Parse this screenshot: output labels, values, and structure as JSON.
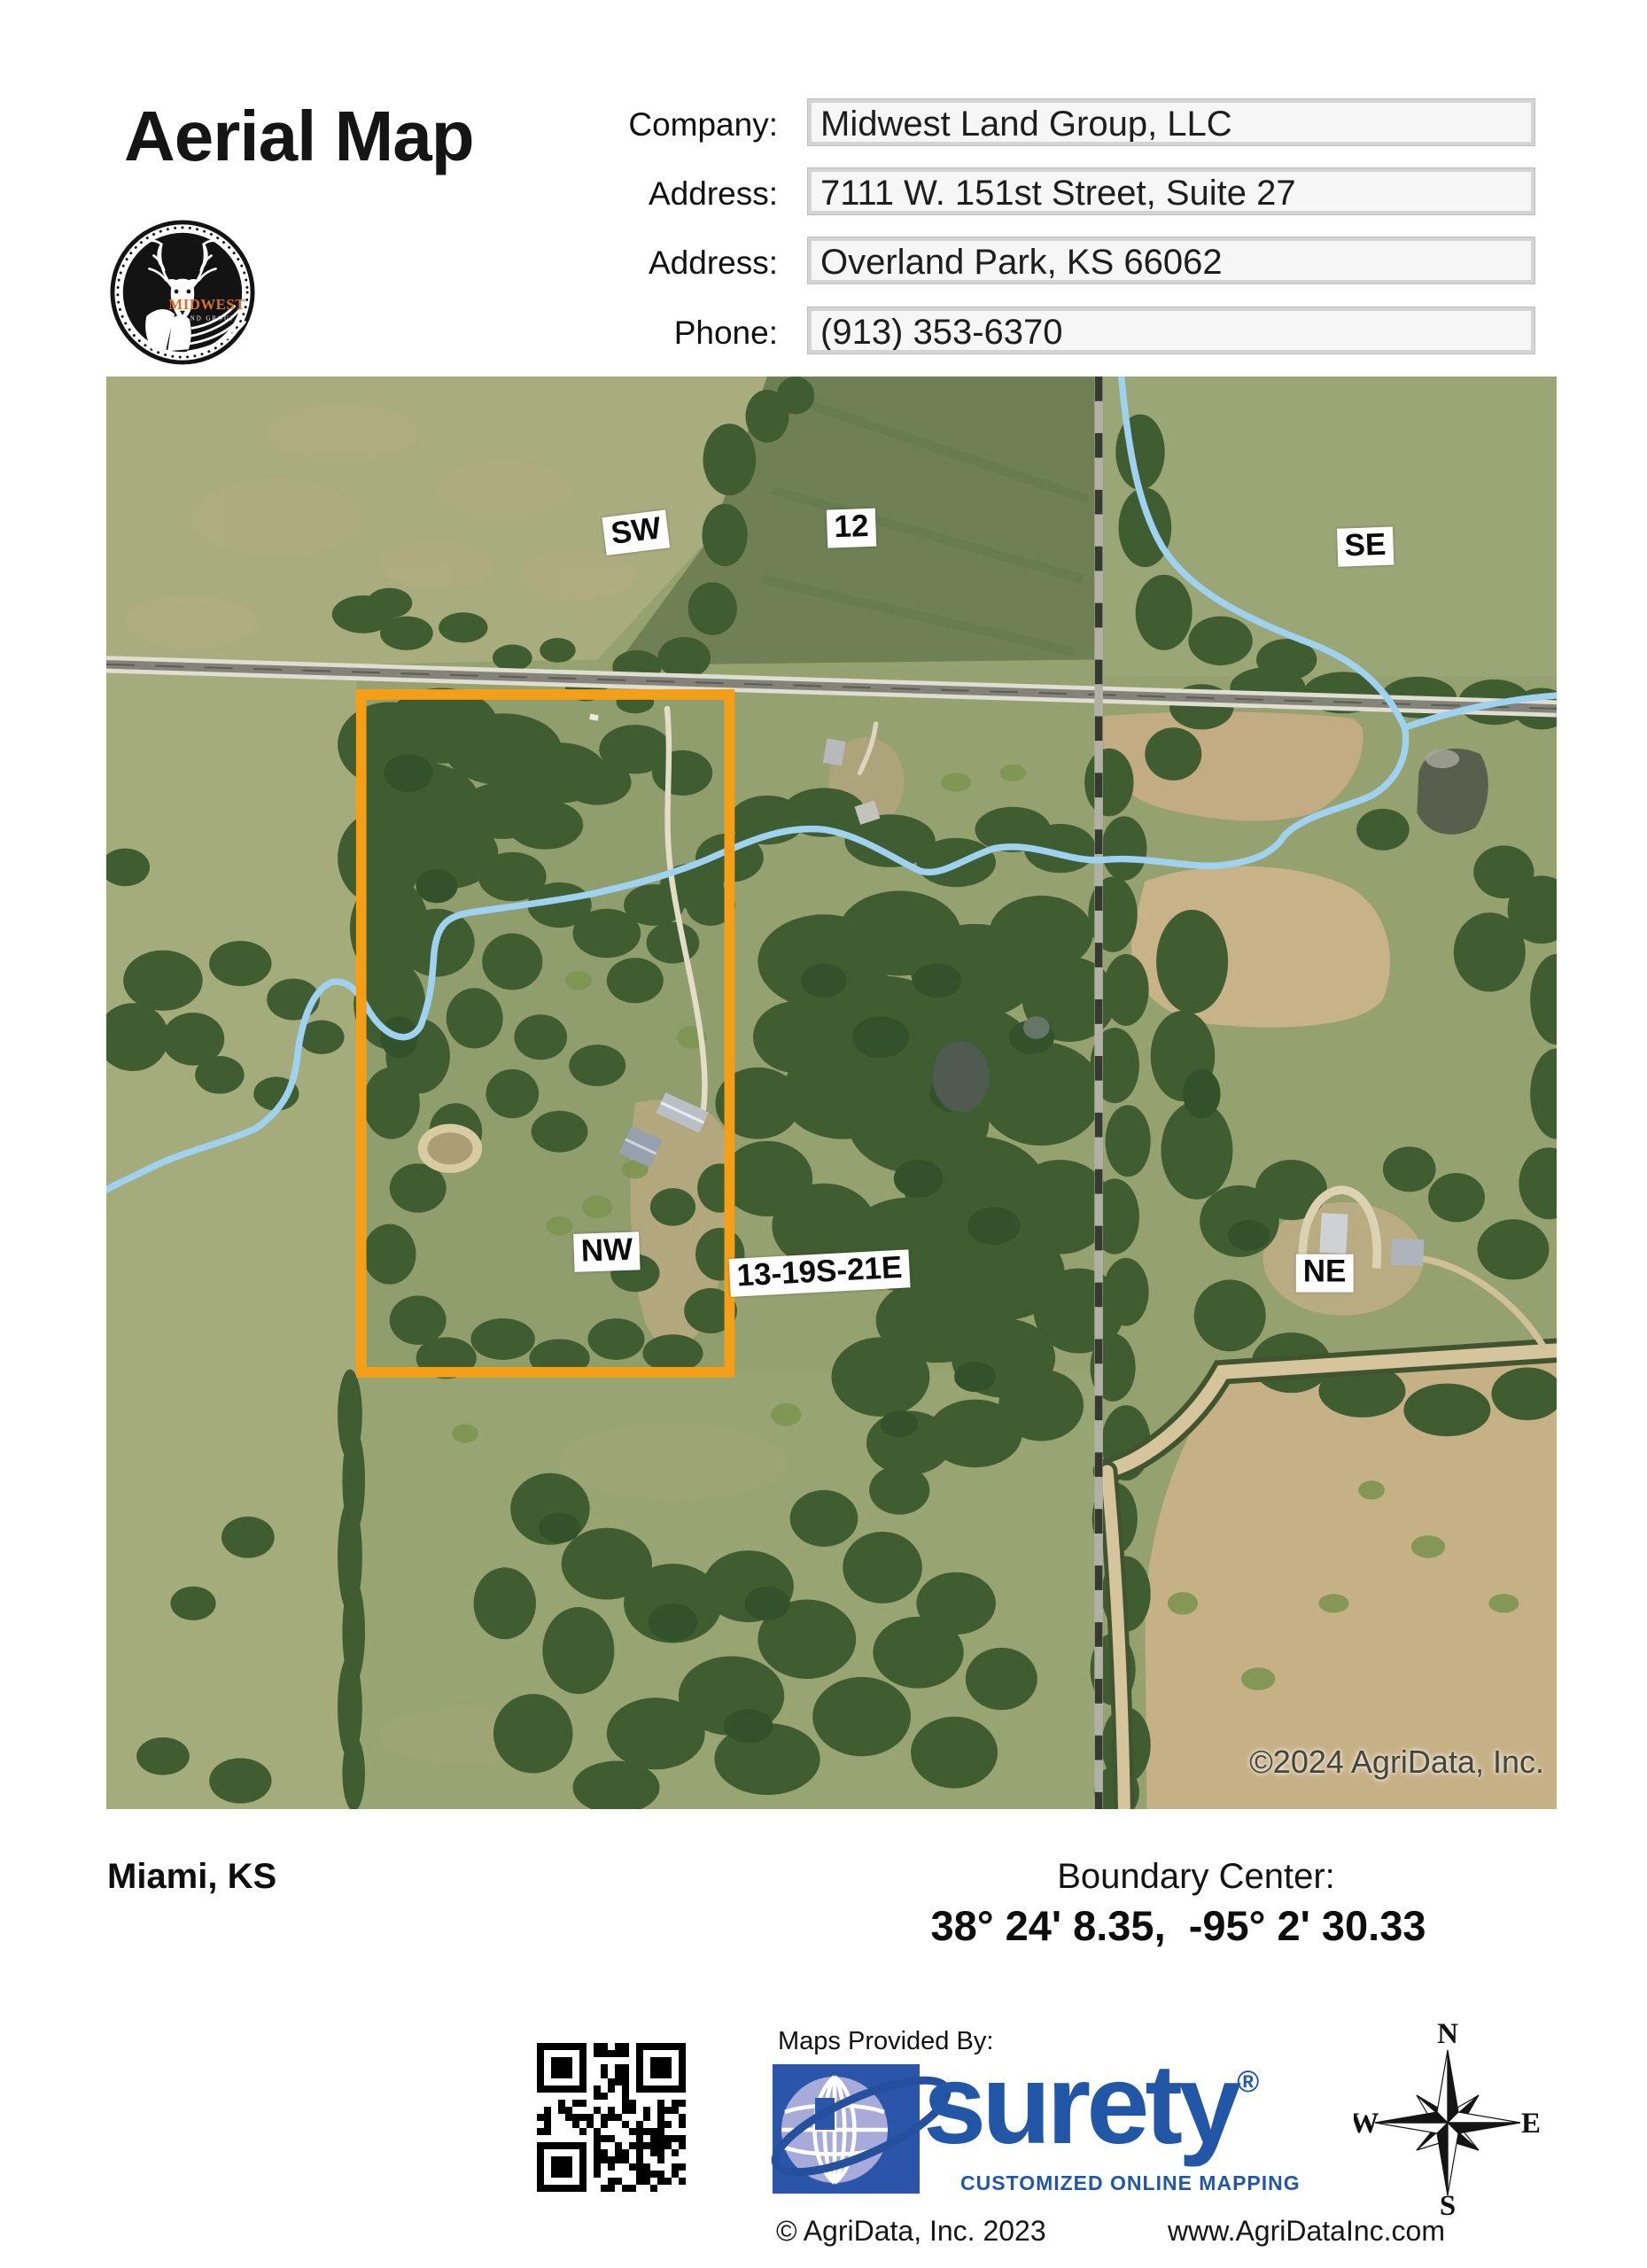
{
  "header": {
    "title": "Aerial Map",
    "logo": {
      "brand": "MIDWEST",
      "subtitle": "LAND GROUP"
    },
    "fields": [
      {
        "label": "Company:",
        "value": "Midwest Land Group, LLC"
      },
      {
        "label": "Address:",
        "value": "7111 W. 151st Street, Suite 27"
      },
      {
        "label": "Address:",
        "value": "Overland Park, KS 66062"
      },
      {
        "label": "Phone:",
        "value": "(913) 353-6370"
      }
    ]
  },
  "map": {
    "section_labels": [
      {
        "text": "SW"
      },
      {
        "text": "12"
      },
      {
        "text": "SE"
      },
      {
        "text": "NW"
      },
      {
        "text": "13-19S-21E"
      },
      {
        "text": "NE"
      }
    ],
    "copyright": "©2024 AgriData, Inc.",
    "colors": {
      "boundary": "#F59E18",
      "creek": "#9ED2F0"
    }
  },
  "footer": {
    "location": "Miami, KS",
    "boundary_center_label": "Boundary Center:",
    "boundary_center_value": "38° 24' 8.35,  -95° 2' 30.33",
    "maps_provided_by": "Maps Provided By:",
    "surety_name": "surety",
    "surety_reg": "®",
    "surety_tagline": "CUSTOMIZED ONLINE MAPPING",
    "agridata_copyright": "© AgriData, Inc. 2023",
    "agridata_url": "www.AgriDataInc.com",
    "compass": {
      "n": "N",
      "e": "E",
      "s": "S",
      "w": "W"
    }
  }
}
